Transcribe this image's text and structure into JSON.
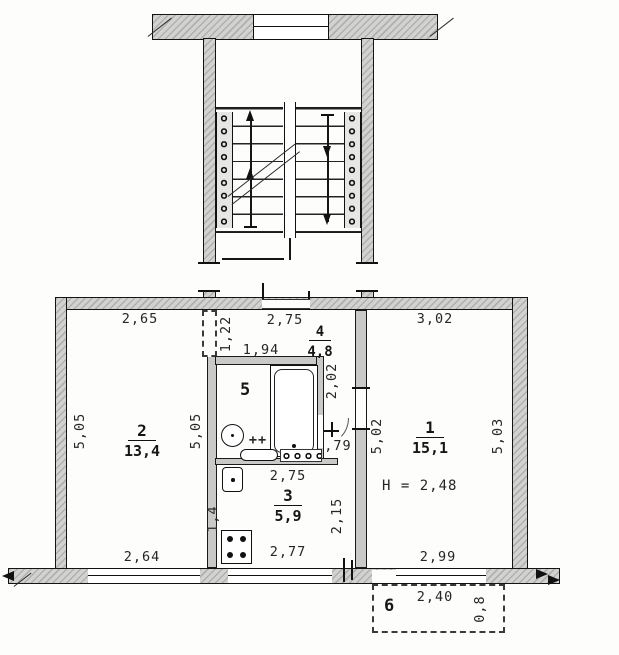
{
  "rooms": {
    "room1": {
      "number": "1",
      "area": "15,1",
      "ceiling_height": "H = 2,48"
    },
    "room2": {
      "number": "2",
      "area": "13,4"
    },
    "room3": {
      "number": "3",
      "area": "5,9"
    },
    "room4": {
      "number": "4",
      "area": "4,8"
    },
    "room5": {
      "number": "5"
    },
    "room6": {
      "number": "6"
    }
  },
  "dims": {
    "room2_top": "2,65",
    "hall_top": "2,75",
    "room1_top": "3,02",
    "bath_width": "1,94",
    "closet_left": "1,22",
    "room2_left": "5,05",
    "room2_right": "5,05",
    "room1_left": "5,02",
    "room1_right": "5,03",
    "bath_depth": "2,02",
    "wc_width": ",79",
    "bath_marks": "++",
    "kitchen_top": "2,75",
    "kitchen_bottom": "2,77",
    "kitchen_right": "2,15",
    "kitchen_left": "1,4",
    "room2_window": "2,64",
    "room1_window": "2,99",
    "balcony_width": "2,40",
    "balcony_depth": "0,8"
  }
}
